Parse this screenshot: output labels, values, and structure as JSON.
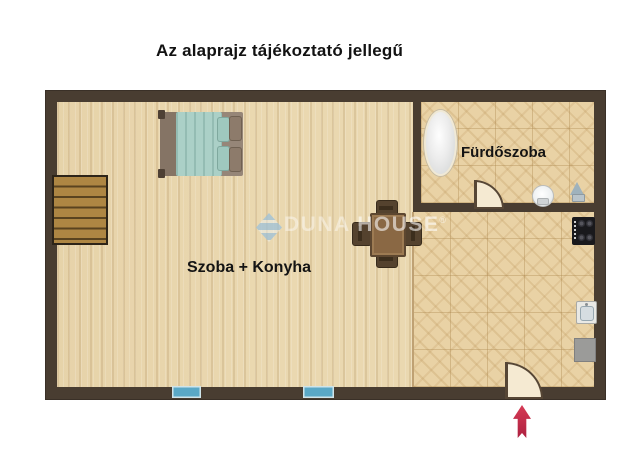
{
  "title": "Az alaprajz tájékoztató jellegű",
  "floorplan": {
    "rooms": {
      "main": {
        "label": "Szoba + Konyha",
        "floor": "wood"
      },
      "bathroom": {
        "label": "Fürdőszoba",
        "floor": "tile"
      }
    },
    "furniture_icons": [
      "stairs-icon",
      "double-bed-icon",
      "dining-table-icon",
      "chair-icon",
      "bathtub-icon",
      "toilet-icon",
      "washbasin-icon",
      "stove-icon",
      "kitchen-sink-icon",
      "appliance-icon"
    ],
    "door_icons": [
      "bathroom-door-icon",
      "entrance-door-icon"
    ],
    "window_icons": [
      "window-icon",
      "window-icon"
    ],
    "entrance_arrow_icon": "up-arrow-icon"
  },
  "watermark": {
    "brand": "DUNA",
    "brand2": "HOUSE",
    "reg": "®"
  },
  "colors": {
    "wall": "#493d31",
    "wood_floor": "#ead8b0",
    "tile_floor": "#e9d2a5",
    "window": "#5aa8c6",
    "door": "#f5ead2",
    "entrance_arrow": "#c22b4a",
    "bed_blanket": "#abd0c7",
    "watermark_blue": "#9ac0db",
    "title_text": "#121212"
  }
}
